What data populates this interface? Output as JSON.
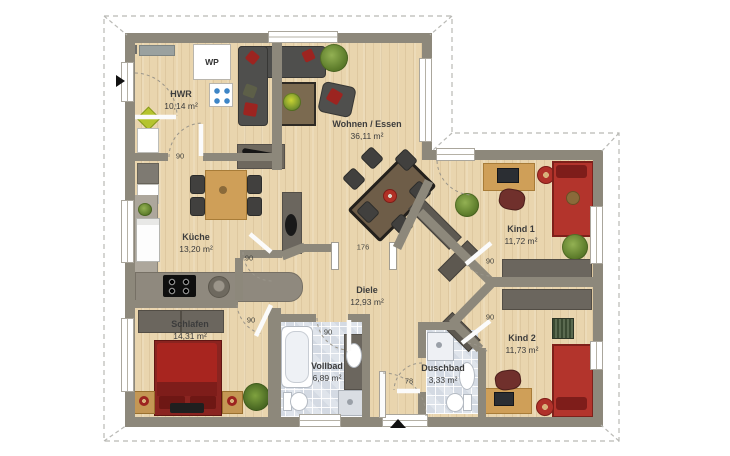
{
  "floorplan": {
    "rooms": [
      {
        "name": "HWR",
        "area": "10,14 m²"
      },
      {
        "name": "Wohnen / Essen",
        "area": "36,11 m²"
      },
      {
        "name": "Küche",
        "area": "13,20 m²"
      },
      {
        "name": "Diele",
        "area": "12,93 m²"
      },
      {
        "name": "Schlafen",
        "area": "14,31 m²"
      },
      {
        "name": "Vollbad",
        "area": "6,89 m²"
      },
      {
        "name": "Duschbad",
        "area": "3,33 m²"
      },
      {
        "name": "Kind 1",
        "area": "11,72 m²"
      },
      {
        "name": "Kind 2",
        "area": "11,73 m²"
      }
    ],
    "door_widths": [
      "90",
      "90",
      "90",
      "90",
      "78",
      "90",
      "90",
      "176"
    ],
    "equipment": {
      "wp_label": "WP"
    },
    "colors": {
      "wall": "#8d887b",
      "wood_floor": "#e9d5ae",
      "tile_floor": "#dfe4eb",
      "bed_red": "#a8251f",
      "furniture_dark": "#4f4f4d",
      "wood_furniture": "#cf9f58",
      "plant_green": "#5d7c2b",
      "roof_outline": "#b9b9b5"
    }
  }
}
